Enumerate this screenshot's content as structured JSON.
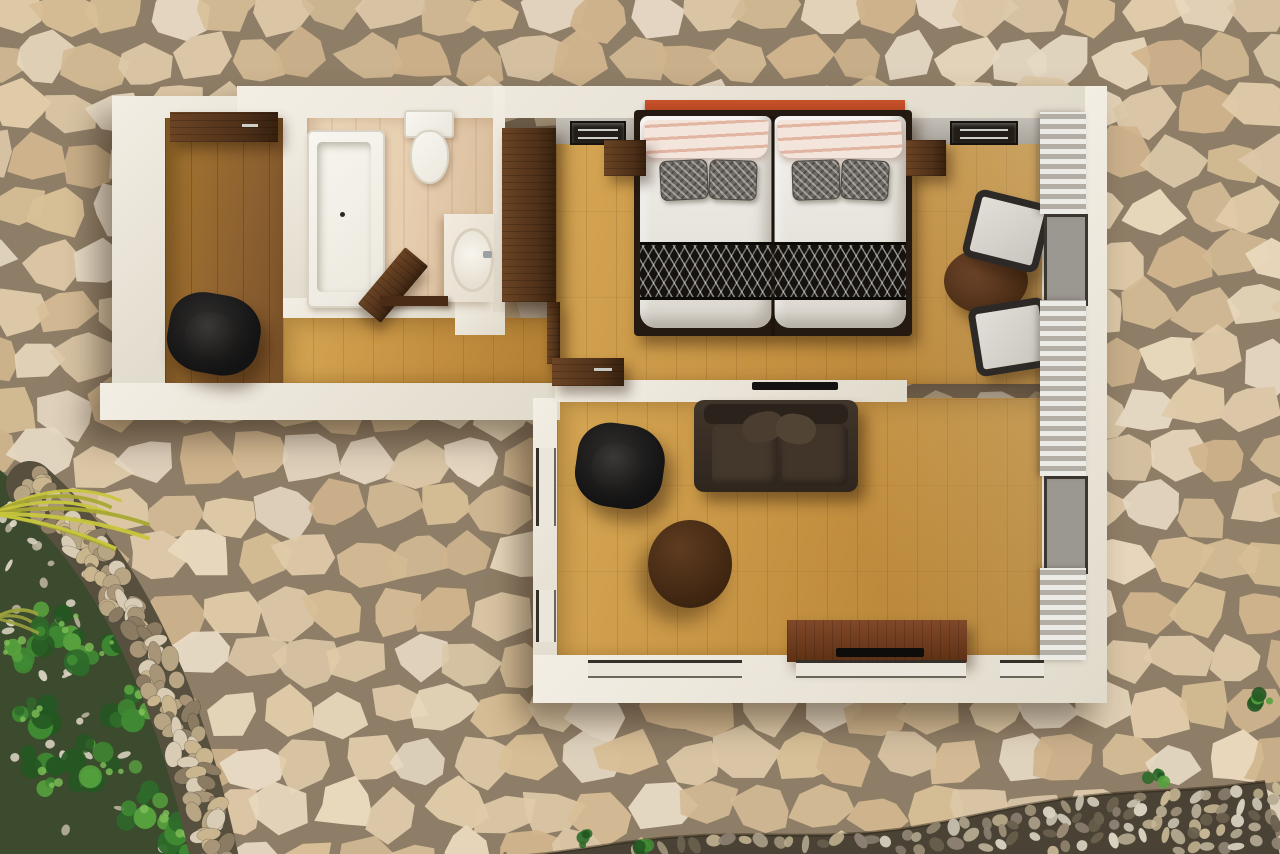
{
  "scene": {
    "type": "3d-floor-plan-top-down-render",
    "subject": "one-bedroom suite viewed from directly above",
    "surroundings": "flagstone paved courtyard with garden bed, stone borders and palm fronds",
    "width": 1280,
    "height": 854
  },
  "palette": {
    "grout": "#8f7e67",
    "wall": "#f3eee4",
    "wallEdge": "#e0dacb",
    "woodGold": "#c28f3f",
    "woodGoldLight": "#d6a754",
    "woodEntry": "#8d6130",
    "tileBath": "#e6cdaf",
    "walnut": "#4d2f18",
    "headboardRed": "#c04a24",
    "sofaBrown": "#372d24",
    "runnerDark": "#16130e",
    "curtainLight": "#edebe6",
    "curtainDark": "#b2ada5",
    "gardenSoil": "#3c4a2d",
    "bandDark": "#4a4335"
  },
  "exterior": {
    "flagstone": {
      "colors": [
        "#e0cba9",
        "#d8bf97",
        "#e8d8bc",
        "#cfb48d",
        "#e6d9c4",
        "#d2ba94",
        "#dcc8a8"
      ],
      "grout": "#8f7e67"
    },
    "garden": {
      "greens": [
        "#2e6b2a",
        "#3f8a33",
        "#57a13e",
        "#245722"
      ],
      "pebbles": [
        "#d7d0bf",
        "#b9b19c",
        "#e2dccb"
      ],
      "bushClusters": [
        [
          58,
          628
        ],
        [
          132,
          702
        ],
        [
          52,
          772
        ],
        [
          150,
          806
        ],
        [
          96,
          648
        ],
        [
          38,
          712
        ],
        [
          185,
          838
        ],
        [
          110,
          760
        ],
        [
          20,
          650
        ]
      ]
    },
    "borderStones": [
      "#c9b58e",
      "#a89577",
      "#d8ccb4",
      "#8a7b62",
      "#b7a584"
    ],
    "bandPebbles": [
      "#d9d2c0",
      "#b6ab93",
      "#8c8172",
      "#6b614e",
      "#c7b795",
      "#9a8d76"
    ],
    "frondColors": [
      "#c8c63e",
      "#a8a832"
    ],
    "tufts": [
      [
        588,
        840
      ],
      [
        1155,
        776
      ],
      [
        1262,
        700
      ],
      [
        640,
        848
      ]
    ]
  },
  "rooms": [
    {
      "id": "entry-hall",
      "furniture": [
        "entry-console",
        "entry-lounge-chair"
      ]
    },
    {
      "id": "bathroom",
      "furniture": [
        "bathtub",
        "toilet",
        "vanity-counter",
        "sink",
        "storage-ledge"
      ]
    },
    {
      "id": "hallway",
      "furniture": [
        "hall-desk",
        "open-door"
      ]
    },
    {
      "id": "bedroom",
      "furniture": [
        "headboard",
        "double-bed",
        "pillows",
        "bed-runner",
        "nightstand-left",
        "nightstand-right",
        "wardrobe",
        "built-in-drawers-left",
        "built-in-drawers-right",
        "round-table",
        "bistro-chair-upper",
        "bistro-chair-lower",
        "curtains",
        "glass-doors"
      ]
    },
    {
      "id": "living-room",
      "furniture": [
        "sofa",
        "swivel-armchair",
        "coffee-table",
        "tv-console",
        "tv",
        "wall-tv",
        "window-row"
      ]
    }
  ]
}
